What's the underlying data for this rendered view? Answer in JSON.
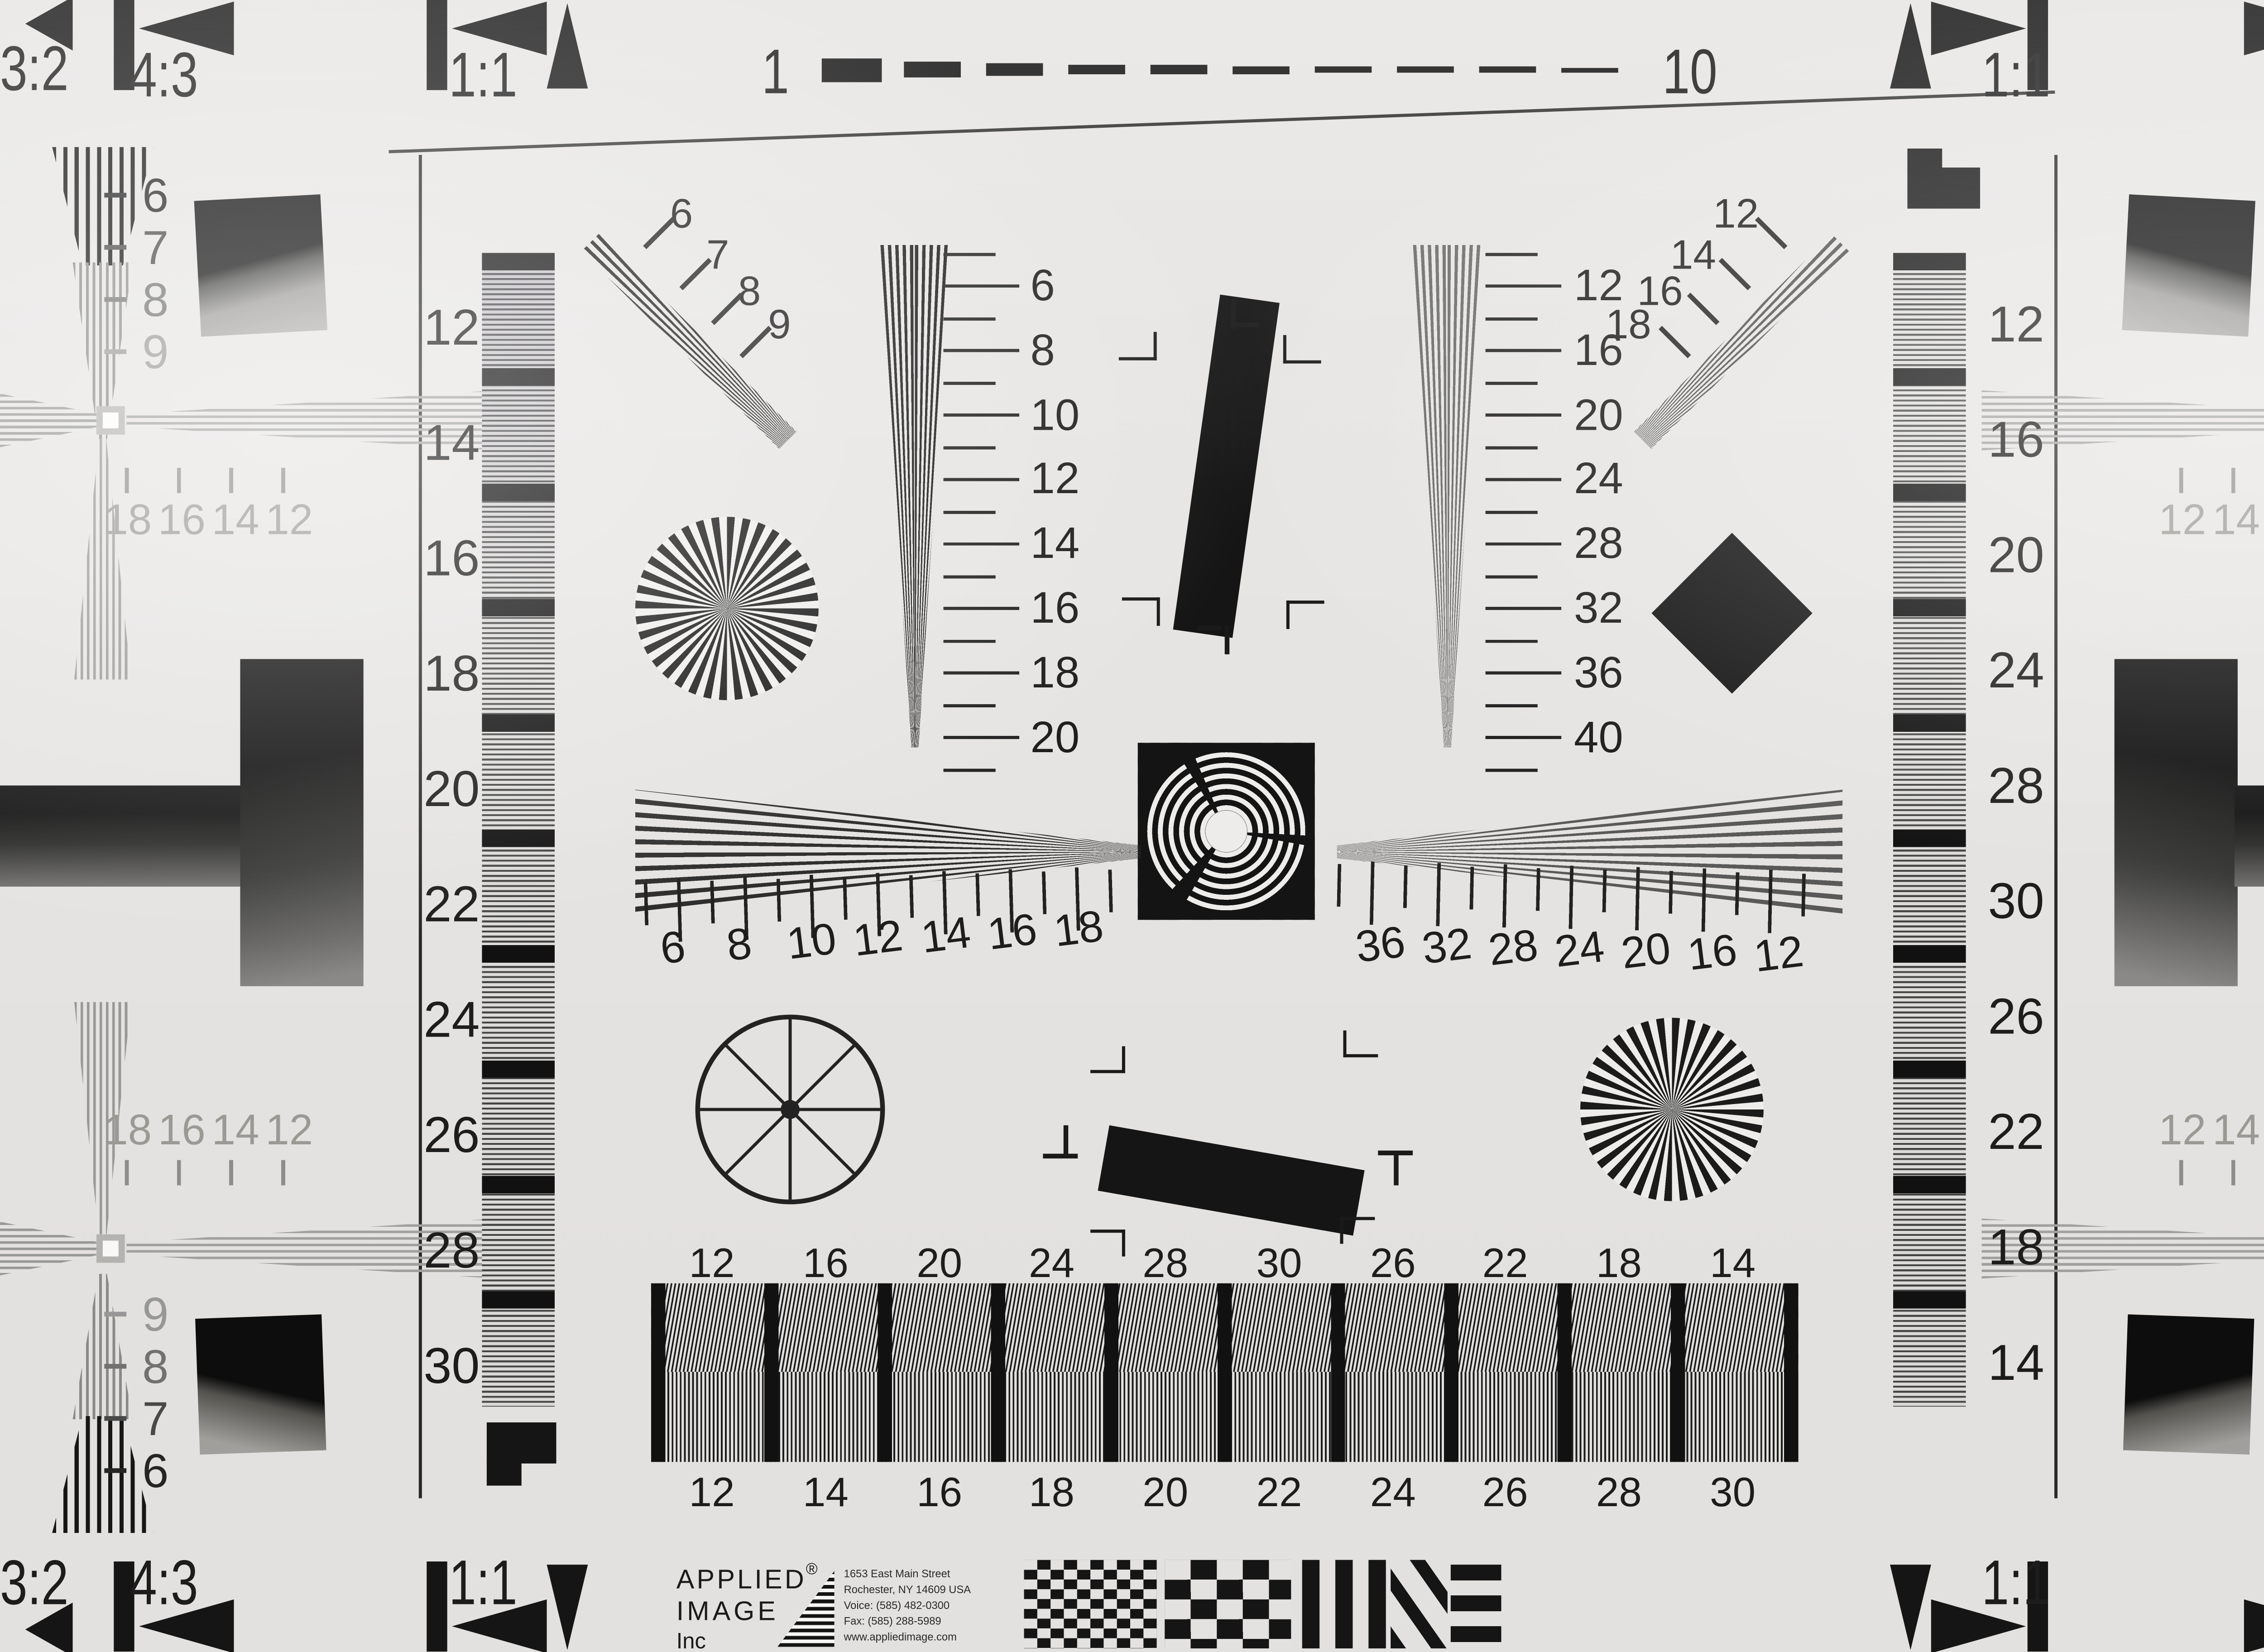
{
  "corners": {
    "tl": [
      "3:2",
      "4:3",
      "1:1"
    ],
    "tr": [
      "1:1",
      "4:3",
      "3:2"
    ],
    "bl": [
      "3:2",
      "4:3",
      "1:1"
    ],
    "br": [
      "1:1",
      "4:3",
      "3:2"
    ]
  },
  "top_scale": {
    "start": "1",
    "end": "10"
  },
  "left_bar": {
    "labels": [
      "12",
      "14",
      "16",
      "18",
      "20",
      "22",
      "24",
      "26",
      "28",
      "30"
    ]
  },
  "right_bar": {
    "labels": [
      "12",
      "16",
      "20",
      "24",
      "28",
      "30",
      "26",
      "22",
      "18",
      "14"
    ]
  },
  "tl_wedge": {
    "labels": [
      "6",
      "7",
      "8",
      "9"
    ]
  },
  "tr_wedge": {
    "labels": [
      "12",
      "14",
      "16",
      "18"
    ]
  },
  "left_vscale": {
    "labels": [
      "6",
      "8",
      "10",
      "12",
      "14",
      "16",
      "18",
      "20"
    ]
  },
  "right_vscale": {
    "labels": [
      "12",
      "16",
      "20",
      "24",
      "28",
      "32",
      "36",
      "40"
    ]
  },
  "ruler_left": {
    "labels": [
      "6",
      "8",
      "10",
      "12",
      "14",
      "16",
      "18"
    ]
  },
  "ruler_right": {
    "labels": [
      "36",
      "32",
      "28",
      "24",
      "20",
      "16",
      "12"
    ]
  },
  "grating": {
    "top": [
      "12",
      "16",
      "20",
      "24",
      "28",
      "30",
      "26",
      "22",
      "18",
      "14"
    ],
    "bottom": [
      "12",
      "14",
      "16",
      "18",
      "20",
      "22",
      "24",
      "26",
      "28",
      "30"
    ]
  },
  "cross": {
    "tl": {
      "rows": [
        "6",
        "7",
        "8",
        "9"
      ],
      "ticks": [
        "18",
        "16",
        "14",
        "12"
      ]
    },
    "bl": {
      "rows": [
        "9",
        "8",
        "7",
        "6"
      ],
      "ticks": [
        "18",
        "16",
        "14",
        "12"
      ]
    },
    "tr": {
      "rows": [
        "6",
        "7",
        "8",
        "9"
      ],
      "ticks": [
        "12",
        "14",
        "16",
        "18"
      ]
    },
    "br": {
      "rows": [
        "9",
        "8",
        "7",
        "6"
      ],
      "ticks": [
        "12",
        "14",
        "16",
        "18"
      ]
    }
  },
  "edge": {
    "right_partial": "9"
  },
  "logo": {
    "name1": "APPLIED",
    "reg": "®",
    "name2": "IMAGE",
    "name3": "Inc",
    "address": [
      "1653 East Main Street",
      "Rochester, NY  14609  USA",
      "Voice:  (585) 482-0300",
      "Fax:    (585) 288-5989",
      "www.appliedimage.com"
    ]
  },
  "colors": {
    "paper": "#e7e5e3",
    "ink": "#151515",
    "gray_line": "#8f8f8d"
  }
}
